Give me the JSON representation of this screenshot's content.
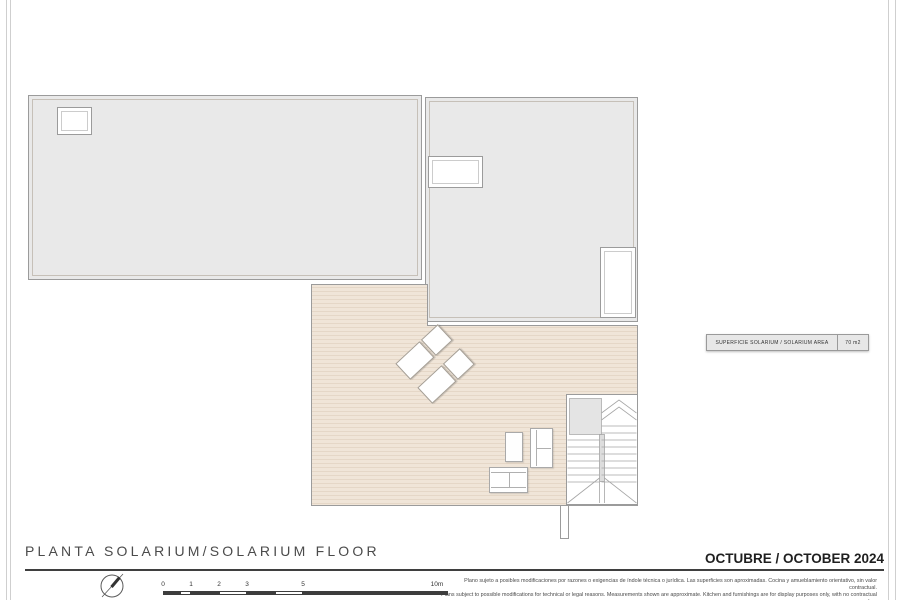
{
  "document": {
    "title": "PLANTA SOLARIUM/SOLARIUM FLOOR",
    "date": "OCTUBRE / OCTOBER 2024",
    "disclaimer": {
      "line_es": "Plano sujeto a posibles modificaciones por razones o exigencias de índole técnica o jurídica. Las superficies son aproximadas. Cocina y amueblamiento orientativo, sin valor contractual.",
      "line_en": "Plans subject to possible modifications for technical or legal reasons. Measurements shown are approximate. Kitchen and furnishings are for display purposes only, with no contractual value."
    }
  },
  "area_table": {
    "label": "SUPERFICIE SOLARIUM / SOLARIUM AREA",
    "value": "70 m2"
  },
  "scale_bar": {
    "tick_labels": [
      "0",
      "1",
      "2",
      "3",
      "5",
      "10m"
    ]
  },
  "plan": {
    "areas": [
      "roof-left",
      "roof-right",
      "solarium-deck",
      "staircase"
    ],
    "furniture": [
      "sun-lounger",
      "sun-lounger",
      "coffee-table",
      "two-seat-sofa",
      "two-seat-sofa"
    ]
  },
  "icons": {
    "compass": "north-arrow-icon"
  },
  "colors": {
    "roof_fill": "#e9e9e9",
    "deck_base": "#f0e5d8",
    "deck_stripe": "#e5d7c7",
    "outline": "#9b9b9b",
    "scale_dark": "#3d3d3d",
    "text": "#3f3f3f"
  }
}
